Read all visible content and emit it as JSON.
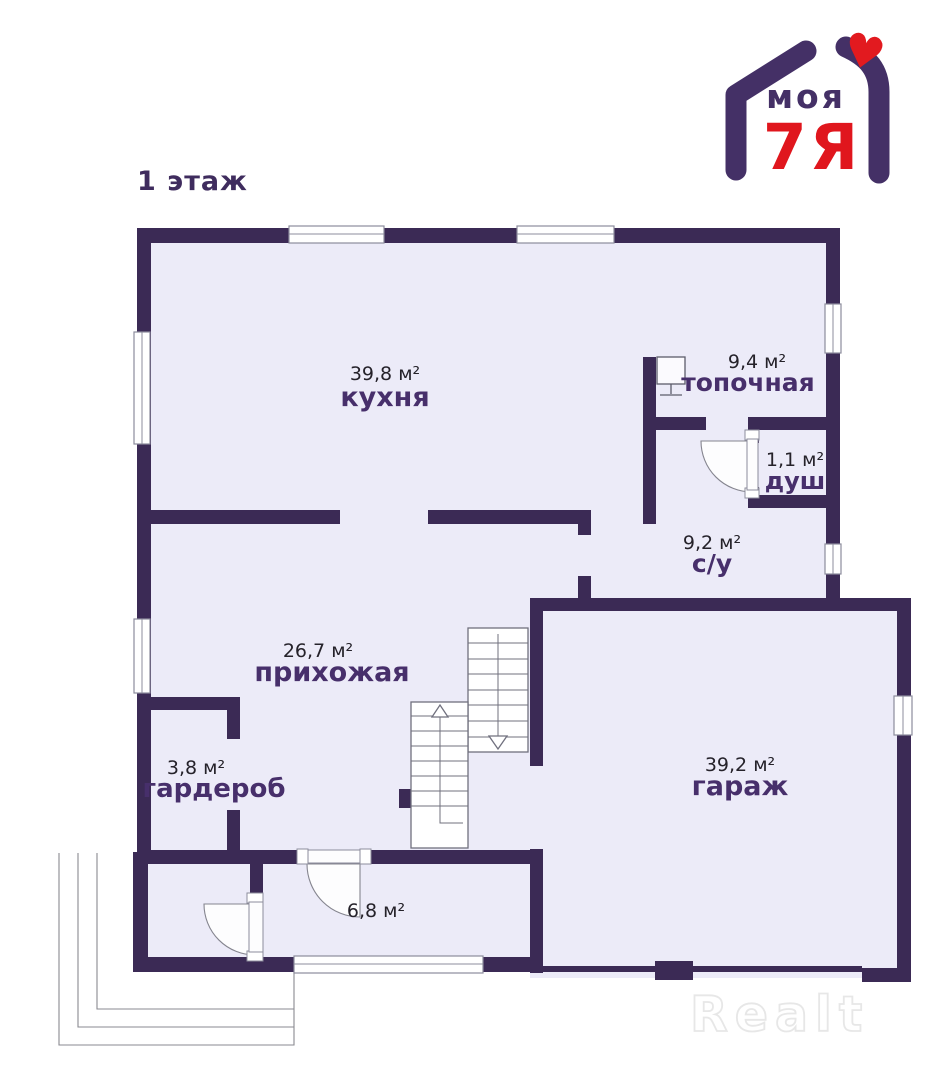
{
  "title": {
    "floor_label": "1 этаж"
  },
  "logo": {
    "word_top": "моя",
    "word_bottom": "7Я",
    "heart_icon": "♥"
  },
  "watermark": {
    "brand": "Realt"
  },
  "colors": {
    "wall": "#3b2a55",
    "room_fill": "#ecebf8",
    "room_name_text": "#472f6b",
    "area_text": "#25222a",
    "logo_purple": "#443066",
    "logo_red": "#e0161d"
  },
  "rooms": [
    {
      "name": "кухня",
      "area": "39,8 м²"
    },
    {
      "name": "топочная",
      "area": "9,4 м²"
    },
    {
      "name": "душ",
      "area": "1,1 м²"
    },
    {
      "name": "с/у",
      "area": "9,2 м²"
    },
    {
      "name": "прихожая",
      "area": "26,7 м²"
    },
    {
      "name": "гардероб",
      "area": "3,8 м²"
    },
    {
      "name": "гараж",
      "area": "39,2 м²"
    },
    {
      "name": "",
      "area": "6,8 м²"
    }
  ]
}
